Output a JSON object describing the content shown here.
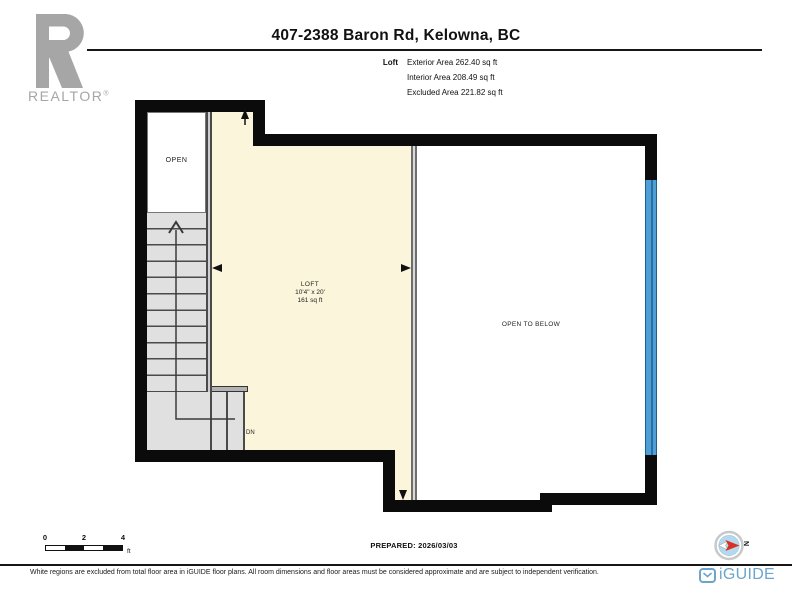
{
  "colors": {
    "wall": "#0b0b0b",
    "beige": "#fbf5dc",
    "window": "#4d9fd6",
    "iguide": "#6ba5ce",
    "realtor": "#a6a6a6",
    "compassred": "#d93025"
  },
  "brand": {
    "realtor": "REALTOR",
    "registered": "®",
    "iguide": "iGUIDE"
  },
  "header": {
    "title": "407-2388 Baron Rd, Kelowna, BC",
    "legend": {
      "label": "Loft",
      "rows": [
        "Exterior Area 262.40 sq ft",
        "Interior Area 208.49 sq ft",
        "Excluded Area 221.82 sq ft"
      ]
    }
  },
  "plan": {
    "labels": {
      "open": "OPEN",
      "loft": {
        "name": "LOFT",
        "dimensions": "10'4\" x 20'",
        "area": "161 sq ft"
      },
      "open_to_below": "OPEN TO BELOW",
      "down": "DN"
    }
  },
  "footer": {
    "scale": {
      "ticks": [
        "0",
        "2",
        "4"
      ],
      "unit": "ft"
    },
    "prepared": "PREPARED: 2026/03/03",
    "compass_north": "N",
    "disclaimer": "White regions are excluded from total floor area in iGUIDE floor plans. All room dimensions and floor areas must be considered approximate and are subject to independent verification."
  }
}
